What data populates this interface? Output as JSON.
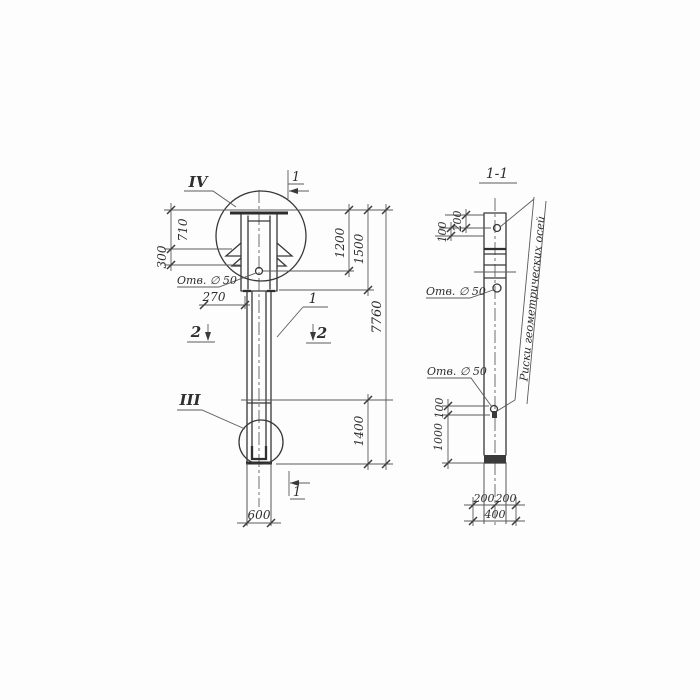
{
  "left_view": {
    "detail_top_label": "IV",
    "detail_bottom_label": "III",
    "section_top_label": "1",
    "section_bottom_label": "1",
    "section_left_label": "2",
    "section_right_label": "2",
    "item_label": "1",
    "hole_label": "Отв. ∅ 50",
    "dims": {
      "head_height": "710",
      "lug_height": "300",
      "hole_offset": "270",
      "top_to_hole": "1200",
      "top_to_joint": "1500",
      "overall_length": "7760",
      "bottom_segment": "1400",
      "width": "600"
    }
  },
  "right_view": {
    "section_title": "1-1",
    "hole_label_mid": "Отв. ∅ 50",
    "hole_label_low": "Отв. ∅ 50",
    "axes_note": "Риски геометрических осей",
    "dims": {
      "top_200": "200",
      "top_100": "100",
      "mid_100": "100",
      "mid_1000": "1000",
      "bottom_left_200": "200",
      "bottom_right_200": "200",
      "bottom_400": "400"
    }
  },
  "colors": {
    "line": "#383838",
    "dim": "#5a5a5a",
    "background": "#fdfdfd"
  }
}
